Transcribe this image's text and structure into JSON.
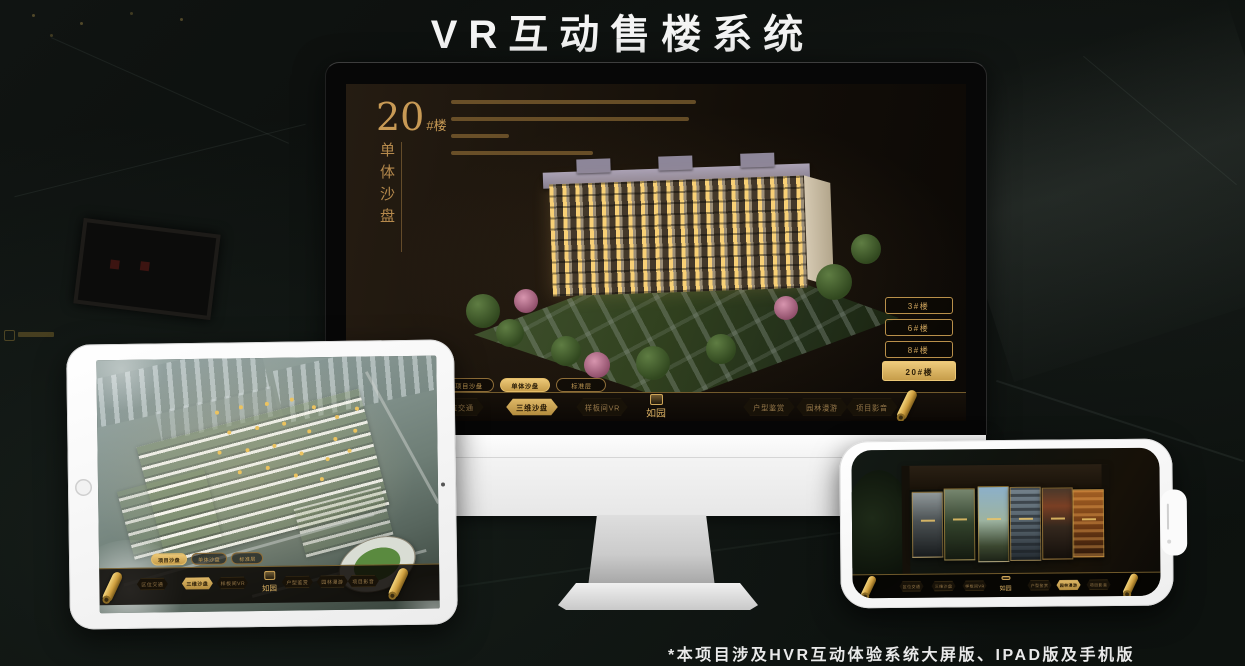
{
  "page": {
    "title": "VR互动售楼系统",
    "footnote": "*本项目涉及HVR互动体验系统大屏版、IPAD版及手机版"
  },
  "colors": {
    "gold": "#c59a55",
    "gold_bright": "#ecc877",
    "screen_dark": "#140f0a",
    "background": "#0b0e0c"
  },
  "nav": {
    "logo": "如园",
    "items": [
      "区位交通",
      "三维沙盘",
      "样板间VR",
      "户型鉴赏",
      "园林漫游",
      "项目影音"
    ]
  },
  "monitor": {
    "heading_number": "20",
    "heading_suffix": "#楼",
    "heading_subtitle": "单体沙盘",
    "floor_buttons": [
      {
        "label": "3#楼",
        "active": false
      },
      {
        "label": "6#楼",
        "active": false
      },
      {
        "label": "8#楼",
        "active": false
      },
      {
        "label": "20#楼",
        "active": true
      }
    ],
    "sub_tabs": [
      {
        "label": "项目沙盘",
        "active": false
      },
      {
        "label": "单体沙盘",
        "active": true
      },
      {
        "label": "标准层",
        "active": false
      }
    ],
    "active_nav_index": 1
  },
  "tablet": {
    "sub_tabs": [
      {
        "label": "项目沙盘",
        "active": true
      },
      {
        "label": "单体沙盘",
        "active": false
      },
      {
        "label": "标准层",
        "active": false
      }
    ],
    "active_nav_index": 1
  },
  "phone": {
    "active_nav_index": 4
  }
}
